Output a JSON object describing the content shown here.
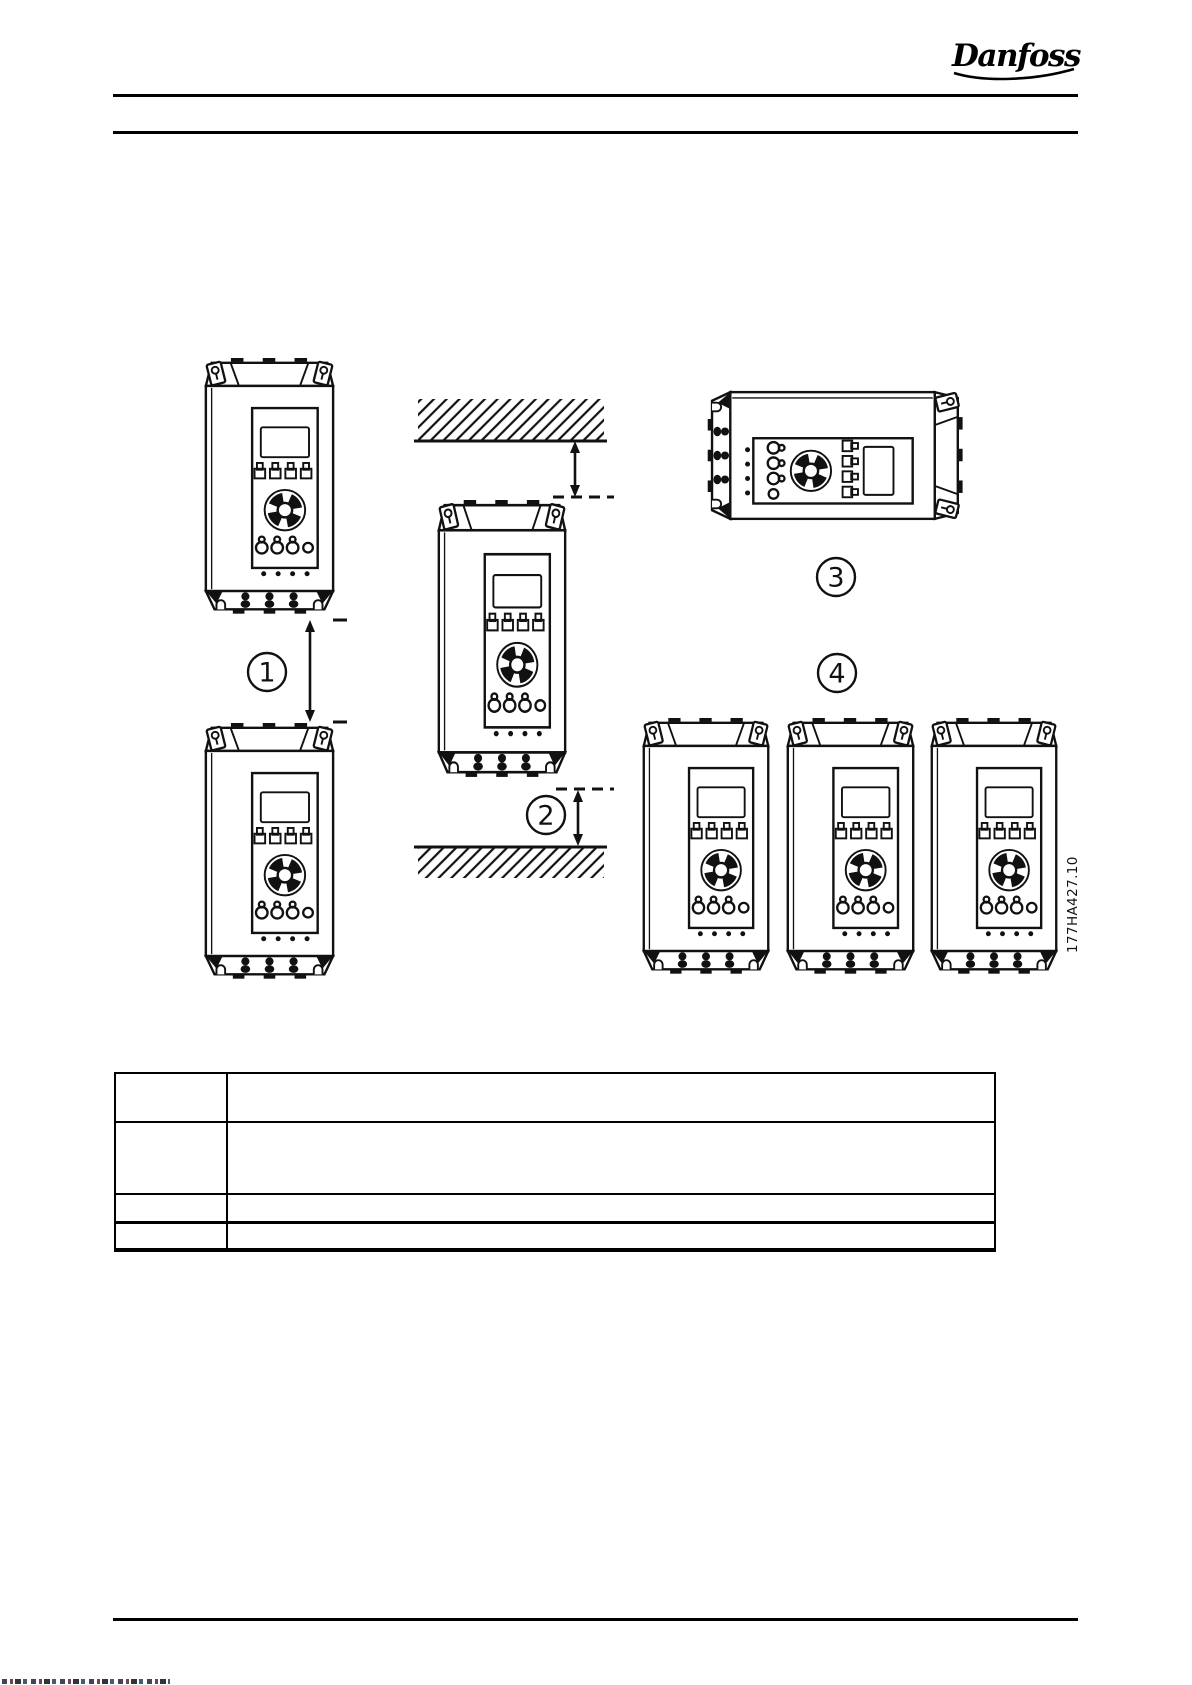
{
  "header": {
    "logo_text": "Danfoss"
  },
  "figure": {
    "drawing_number": "177HA427.10",
    "callouts": [
      {
        "label": "1"
      },
      {
        "label": "2"
      },
      {
        "label": "3"
      },
      {
        "label": "4"
      }
    ]
  },
  "table": {
    "rows": [
      {
        "item": "",
        "description": ""
      },
      {
        "item": "",
        "description": ""
      },
      {
        "item": "",
        "description": ""
      },
      {
        "item": "",
        "description": ""
      }
    ]
  }
}
